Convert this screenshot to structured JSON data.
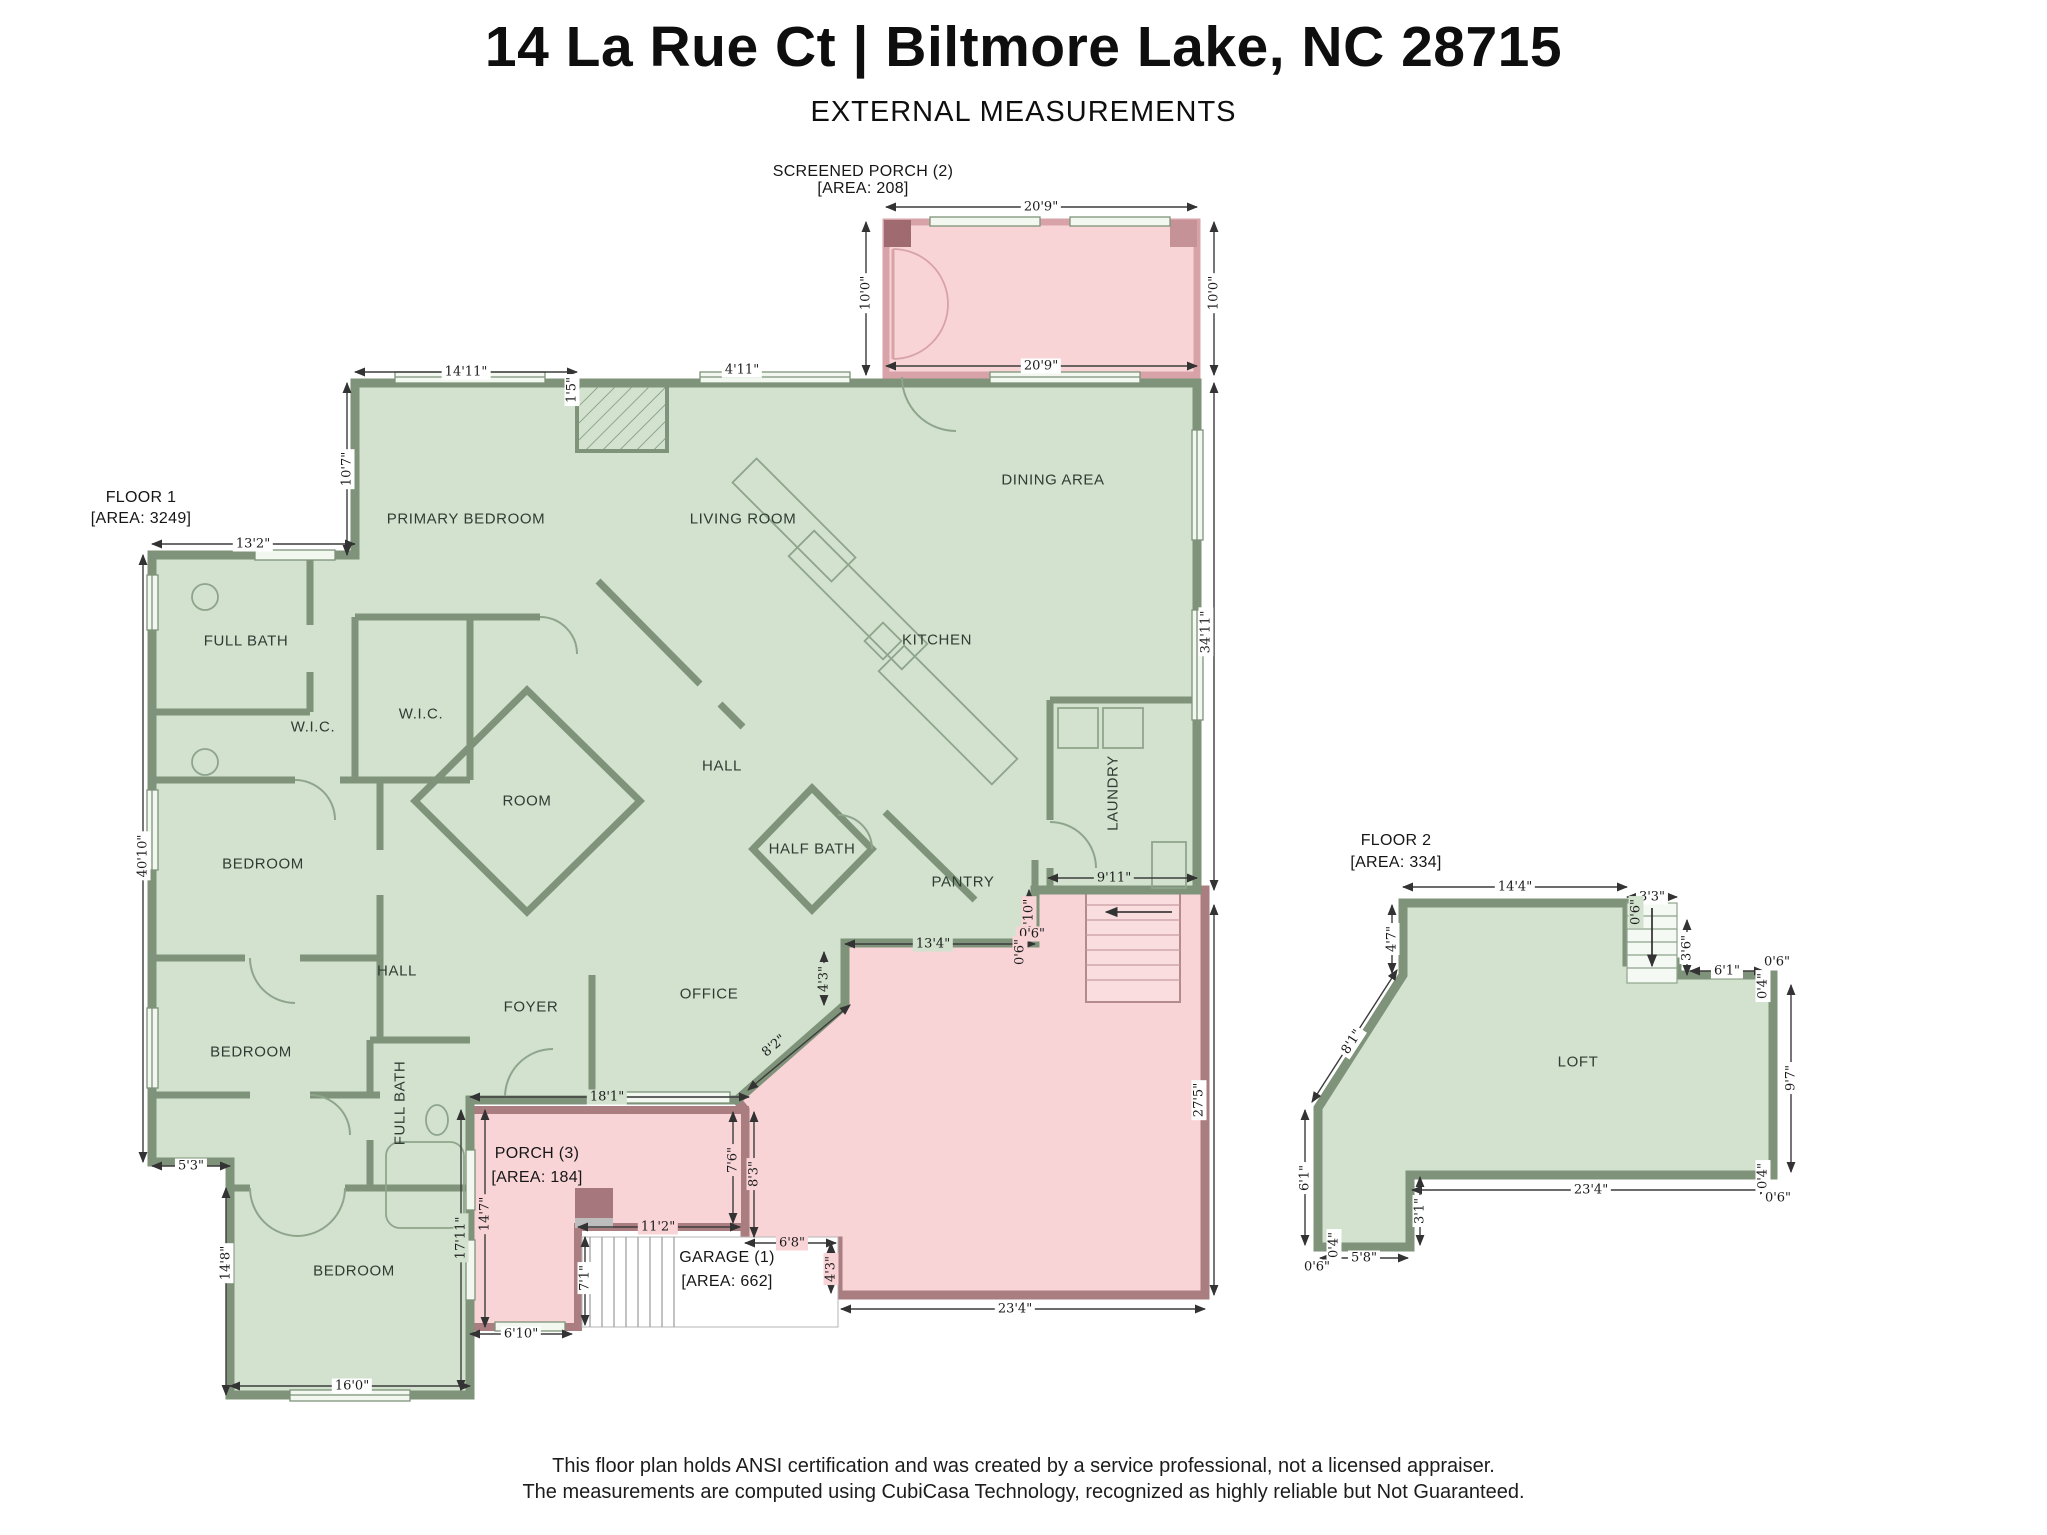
{
  "title": "14 La Rue Ct | Biltmore Lake, NC 28715",
  "subtitle": "EXTERNAL MEASUREMENTS",
  "footer": {
    "line1": "This floor plan holds ANSI certification and was created by a service professional, not a licensed appraiser.",
    "line2": "The measurements are computed using CubiCasa Technology, recognized as highly reliable but Not Guaranteed."
  },
  "colors": {
    "room_fill_green": "#d2e2cf",
    "wall_green": "#7e9379",
    "porch_fill_pink": "#f8d4d7",
    "porch_wall_pink": "#d8a3a8",
    "deck_wall_mauve": "#aa7d81",
    "dimension_text": "#1b1b1b"
  },
  "headings": [
    {
      "t": "FLOOR 1",
      "x": 141,
      "y": 498
    },
    {
      "t": "[AREA: 3249]",
      "x": 141,
      "y": 519
    },
    {
      "t": "SCREENED PORCH (2)",
      "x": 863,
      "y": 172
    },
    {
      "t": "[AREA: 208]",
      "x": 863,
      "y": 189
    },
    {
      "t": "PORCH (3)",
      "x": 537,
      "y": 1154
    },
    {
      "t": "[AREA: 184]",
      "x": 537,
      "y": 1178
    },
    {
      "t": "GARAGE (1)",
      "x": 727,
      "y": 1258
    },
    {
      "t": "[AREA: 662]",
      "x": 727,
      "y": 1282
    },
    {
      "t": "FLOOR 2",
      "x": 1396,
      "y": 841
    },
    {
      "t": "[AREA: 334]",
      "x": 1396,
      "y": 863
    }
  ],
  "rooms": [
    {
      "t": "PRIMARY BEDROOM",
      "x": 466,
      "y": 519
    },
    {
      "t": "LIVING ROOM",
      "x": 743,
      "y": 519
    },
    {
      "t": "DINING AREA",
      "x": 1053,
      "y": 480
    },
    {
      "t": "KITCHEN",
      "x": 937,
      "y": 640
    },
    {
      "t": "FULL BATH",
      "x": 246,
      "y": 641
    },
    {
      "t": "W.I.C.",
      "x": 313,
      "y": 727
    },
    {
      "t": "W.I.C.",
      "x": 421,
      "y": 714
    },
    {
      "t": "HALL",
      "x": 722,
      "y": 766
    },
    {
      "t": "ROOM",
      "x": 527,
      "y": 801
    },
    {
      "t": "HALF BATH",
      "x": 812,
      "y": 849
    },
    {
      "t": "PANTRY",
      "x": 963,
      "y": 882
    },
    {
      "t": "LAUNDRY",
      "x": 1113,
      "y": 793,
      "r": -90
    },
    {
      "t": "BEDROOM",
      "x": 263,
      "y": 864
    },
    {
      "t": "HALL",
      "x": 397,
      "y": 971
    },
    {
      "t": "BEDROOM",
      "x": 251,
      "y": 1052
    },
    {
      "t": "FULL BATH",
      "x": 400,
      "y": 1103,
      "r": -90
    },
    {
      "t": "BEDROOM",
      "x": 354,
      "y": 1271
    },
    {
      "t": "FOYER",
      "x": 531,
      "y": 1007
    },
    {
      "t": "OFFICE",
      "x": 709,
      "y": 994
    },
    {
      "t": "LOFT",
      "x": 1578,
      "y": 1062
    }
  ],
  "dims": [
    {
      "t": "14'11\"",
      "x": 466,
      "y": 372
    },
    {
      "t": "1'5\"",
      "x": 572,
      "y": 390,
      "r": -90
    },
    {
      "t": "4'11\"",
      "x": 742,
      "y": 370
    },
    {
      "t": "20'9\"",
      "x": 1041,
      "y": 207
    },
    {
      "t": "10'0\"",
      "x": 866,
      "y": 293,
      "r": -90
    },
    {
      "t": "20'9\"",
      "x": 1041,
      "y": 366
    },
    {
      "t": "10'0\"",
      "x": 1214,
      "y": 293,
      "r": -90
    },
    {
      "t": "10'7\"",
      "x": 347,
      "y": 469,
      "r": -90
    },
    {
      "t": "13'2\"",
      "x": 253,
      "y": 544
    },
    {
      "t": "40'10\"",
      "x": 143,
      "y": 856,
      "r": -90
    },
    {
      "t": "5'3\"",
      "x": 191,
      "y": 1166
    },
    {
      "t": "14'8\"",
      "x": 226,
      "y": 1263,
      "r": -90
    },
    {
      "t": "16'0\"",
      "x": 352,
      "y": 1386
    },
    {
      "t": "17'11\"",
      "x": 461,
      "y": 1238,
      "r": -90,
      "bg": "g"
    },
    {
      "t": "14'7\"",
      "x": 485,
      "y": 1214,
      "r": -90,
      "bg": "p"
    },
    {
      "t": "6'10\"",
      "x": 521,
      "y": 1334
    },
    {
      "t": "7'1\"",
      "x": 585,
      "y": 1278,
      "r": -90
    },
    {
      "t": "11'2\"",
      "x": 658,
      "y": 1227,
      "bg": "p"
    },
    {
      "t": "6'8\"",
      "x": 792,
      "y": 1243,
      "bg": "p"
    },
    {
      "t": "4'3\"",
      "x": 831,
      "y": 1269,
      "r": -90,
      "bg": "p"
    },
    {
      "t": "23'4\"",
      "x": 1015,
      "y": 1309
    },
    {
      "t": "27'5\"",
      "x": 1199,
      "y": 1100,
      "r": -90
    },
    {
      "t": "34'11\"",
      "x": 1206,
      "y": 632,
      "r": -90
    },
    {
      "t": "9'11\"",
      "x": 1114,
      "y": 878,
      "bg": "g"
    },
    {
      "t": "13'4\"",
      "x": 933,
      "y": 944,
      "bg": "g"
    },
    {
      "t": "3'10\"",
      "x": 1029,
      "y": 916,
      "r": -90,
      "bg": "p"
    },
    {
      "t": "0'6\"",
      "x": 1032,
      "y": 934,
      "bg": "p"
    },
    {
      "t": "0'6\"",
      "x": 1020,
      "y": 952,
      "r": -90,
      "bg": "p"
    },
    {
      "t": "4'3\"",
      "x": 824,
      "y": 979,
      "r": -90,
      "bg": "g"
    },
    {
      "t": "8'2\"",
      "x": 774,
      "y": 1046,
      "r": -40,
      "bg": "g"
    },
    {
      "t": "18'1\"",
      "x": 607,
      "y": 1097,
      "bg": "g"
    },
    {
      "t": "7'6\"",
      "x": 733,
      "y": 1160,
      "r": -90,
      "bg": "p"
    },
    {
      "t": "8'3\"",
      "x": 754,
      "y": 1174,
      "r": -90,
      "bg": "p"
    },
    {
      "t": "14'4\"",
      "x": 1515,
      "y": 887
    },
    {
      "t": "3'3\"",
      "x": 1652,
      "y": 897
    },
    {
      "t": "0'6\"",
      "x": 1636,
      "y": 912,
      "r": -90,
      "bg": "g"
    },
    {
      "t": "3'6\"",
      "x": 1687,
      "y": 948,
      "r": -90
    },
    {
      "t": "6'1\"",
      "x": 1727,
      "y": 971
    },
    {
      "t": "0'6\"",
      "x": 1777,
      "y": 962
    },
    {
      "t": "0'4\"",
      "x": 1763,
      "y": 986,
      "r": -90
    },
    {
      "t": "9'7\"",
      "x": 1791,
      "y": 1078,
      "r": -90
    },
    {
      "t": "0'4\"",
      "x": 1763,
      "y": 1176,
      "r": -90
    },
    {
      "t": "0'6\"",
      "x": 1778,
      "y": 1198
    },
    {
      "t": "23'4\"",
      "x": 1591,
      "y": 1190
    },
    {
      "t": "3'1\"",
      "x": 1420,
      "y": 1211,
      "r": -90
    },
    {
      "t": "5'8\"",
      "x": 1364,
      "y": 1258
    },
    {
      "t": "0'4\"",
      "x": 1334,
      "y": 1245,
      "r": -90
    },
    {
      "t": "0'6\"",
      "x": 1317,
      "y": 1267
    },
    {
      "t": "6'1\"",
      "x": 1305,
      "y": 1178,
      "r": -90
    },
    {
      "t": "8'1\"",
      "x": 1352,
      "y": 1042,
      "r": -57
    },
    {
      "t": "4'7\"",
      "x": 1392,
      "y": 939,
      "r": -90
    }
  ]
}
